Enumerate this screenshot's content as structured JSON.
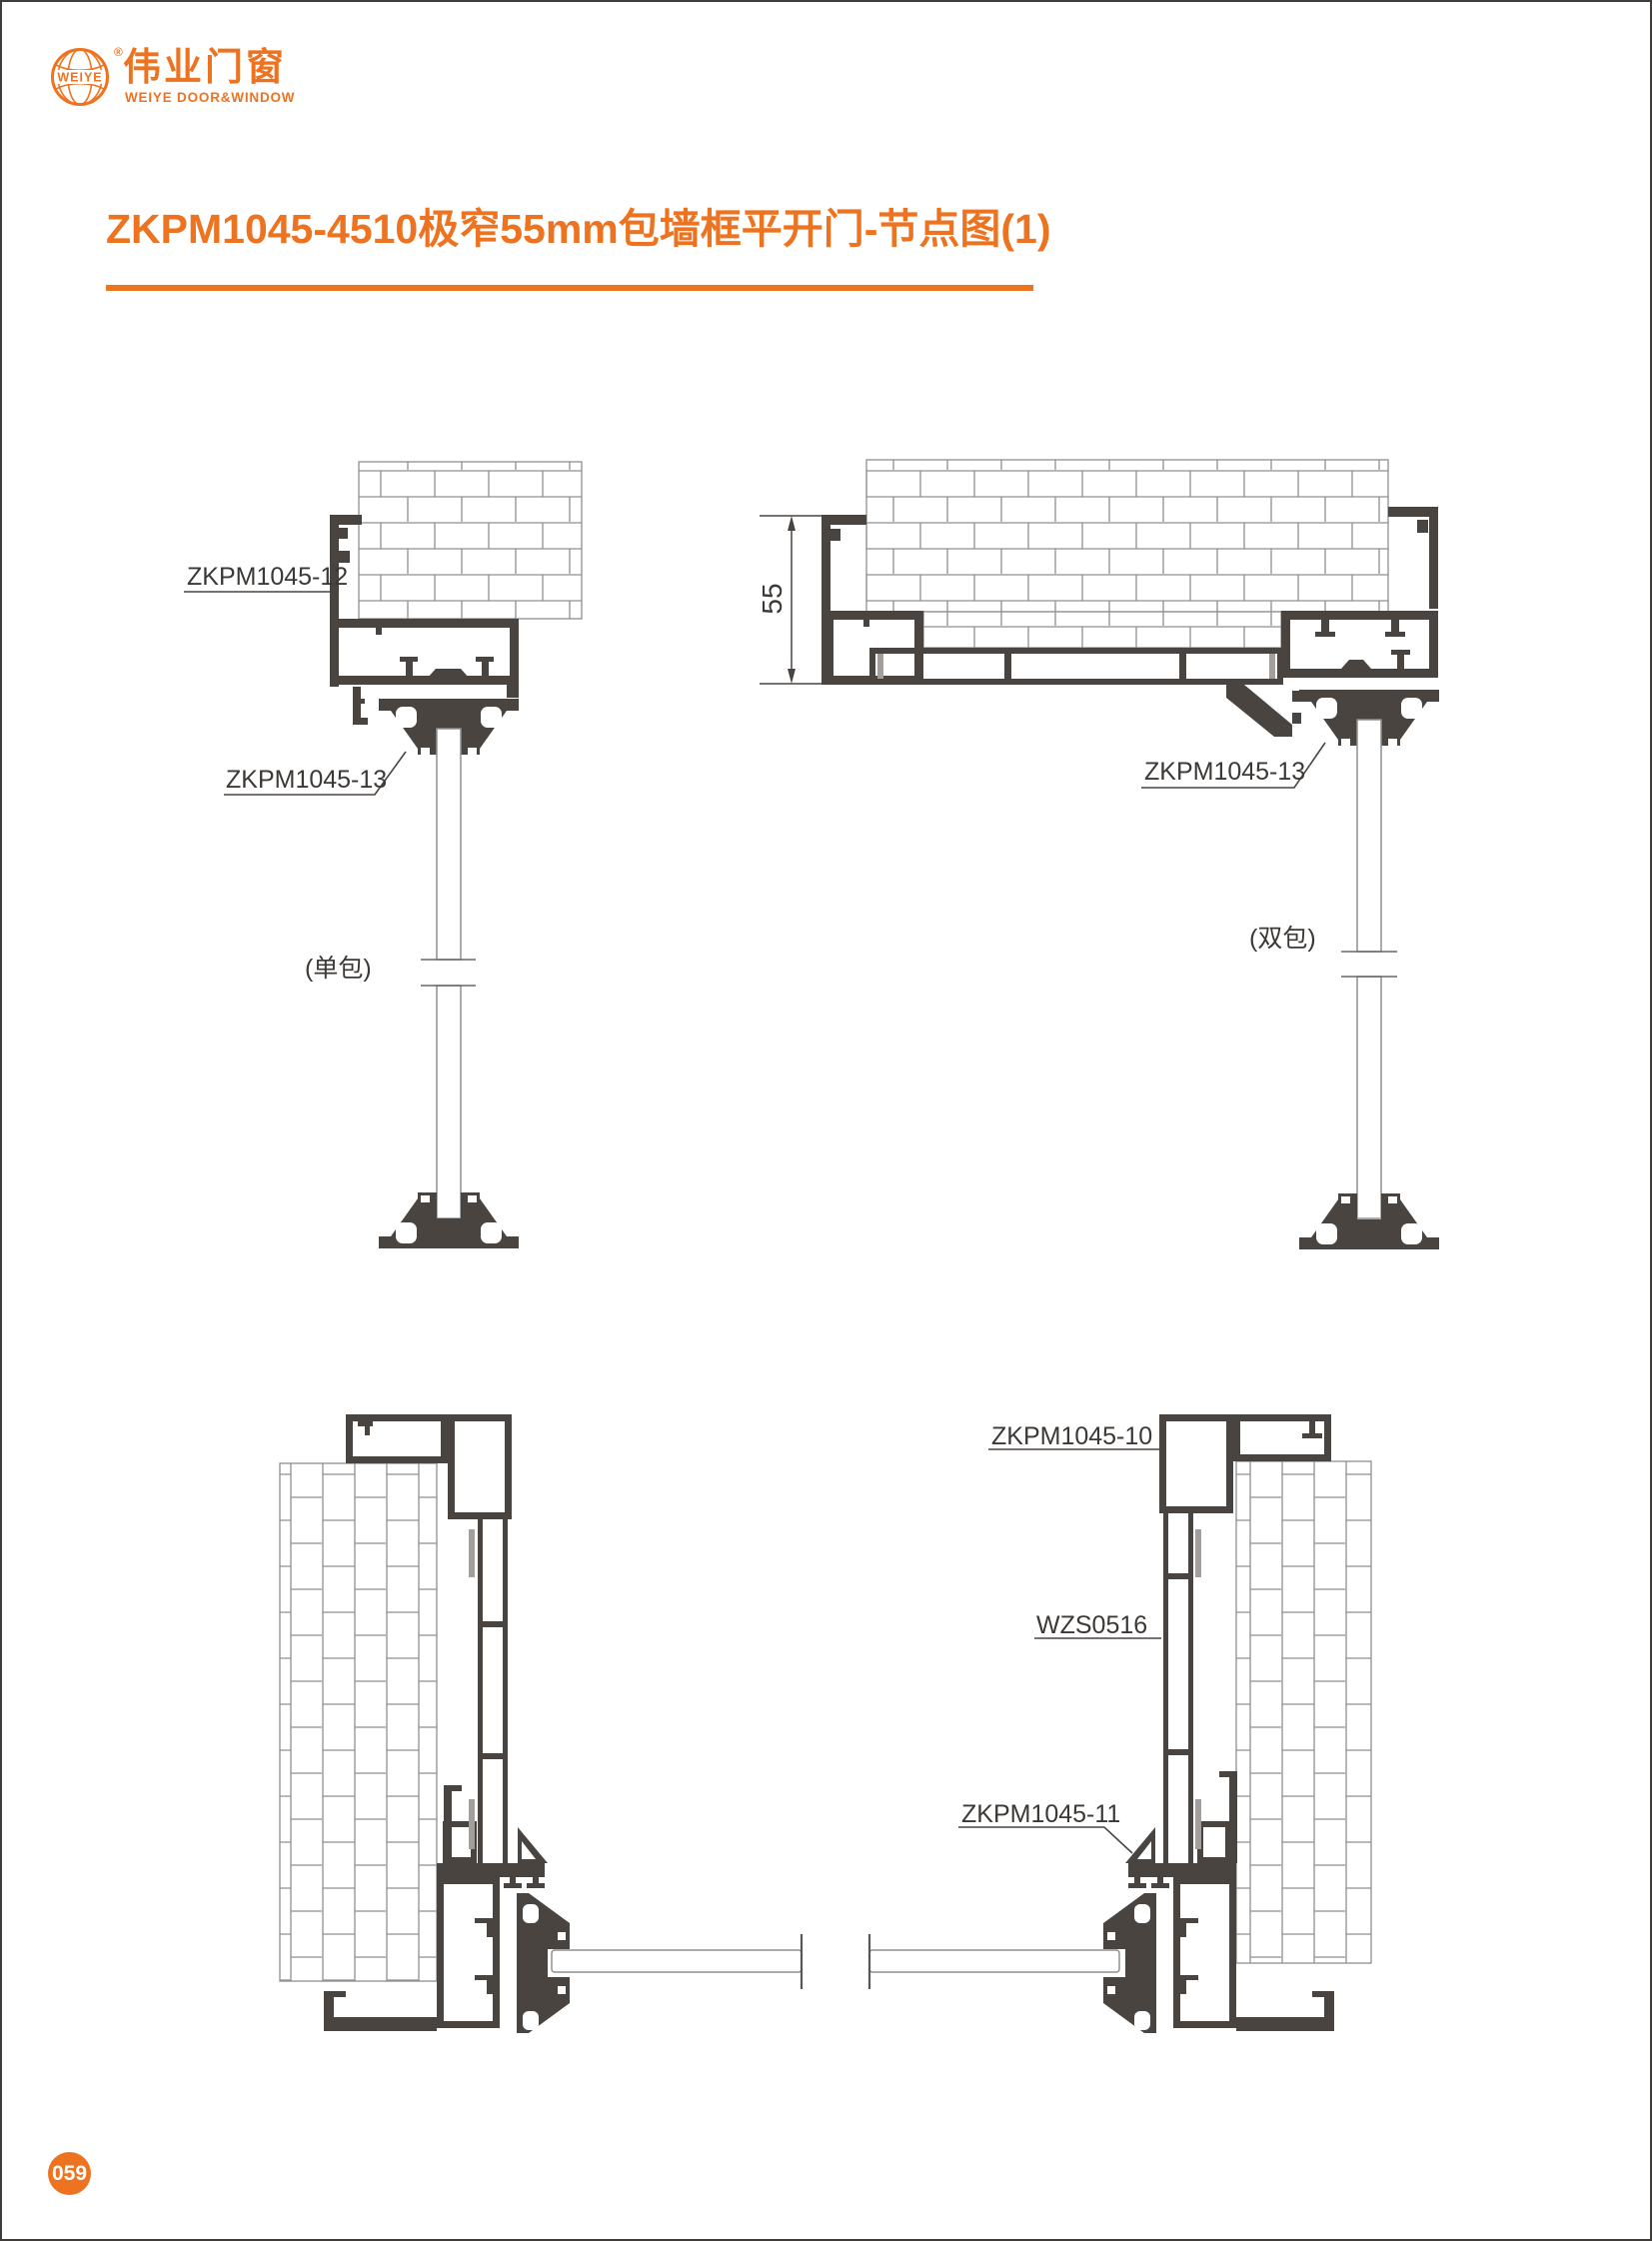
{
  "page": {
    "title": "ZKPM1045-4510极窄55mm包墙框平开门-节点图(1)",
    "number": "059"
  },
  "logo": {
    "globe_text": "WEIYE",
    "registered_mark": "®",
    "name_cn": "伟业门窗",
    "name_en": "WEIYE DOOR&WINDOW"
  },
  "drawings": {
    "top_left": {
      "profile_label": "ZKPM1045-12",
      "bead_label": "ZKPM1045-13",
      "caption": "(单包)"
    },
    "top_right": {
      "dimension_mm": "55",
      "bead_label": "ZKPM1045-13",
      "caption": "(双包)"
    },
    "bottom_right": {
      "frame_label": "ZKPM1045-10",
      "mullion_label": "WZS0516",
      "bead_label": "ZKPM1045-11"
    }
  },
  "colors": {
    "accent_orange": "#ee7320",
    "profile_dark": "#4a4440",
    "brick_line": "#8f8f8f"
  }
}
